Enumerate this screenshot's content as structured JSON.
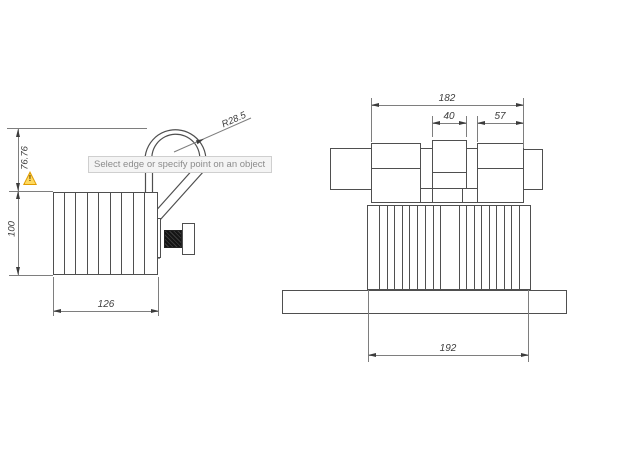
{
  "tooltip": {
    "text": "Select edge or specify point on an object"
  },
  "left_view": {
    "width_label": "126",
    "height_label": "100",
    "shackle_height_label": "76.76",
    "radius_label": "R28.5"
  },
  "right_view": {
    "overall_width_label": "182",
    "center_width_label": "40",
    "side_block_width_label": "57",
    "base_width_label": "192"
  },
  "warning": {
    "mark": "!"
  },
  "colors": {
    "object_line": "#4f4f4f",
    "dimension_line": "#7e7e7e",
    "dimension_text": "#3c3c3c",
    "tooltip_background": "#f4f4f4",
    "tooltip_border": "#cfcfcf",
    "tooltip_text": "#8c8c8c",
    "warning_fill": "#ffd95e",
    "warning_border": "#e09c00"
  }
}
